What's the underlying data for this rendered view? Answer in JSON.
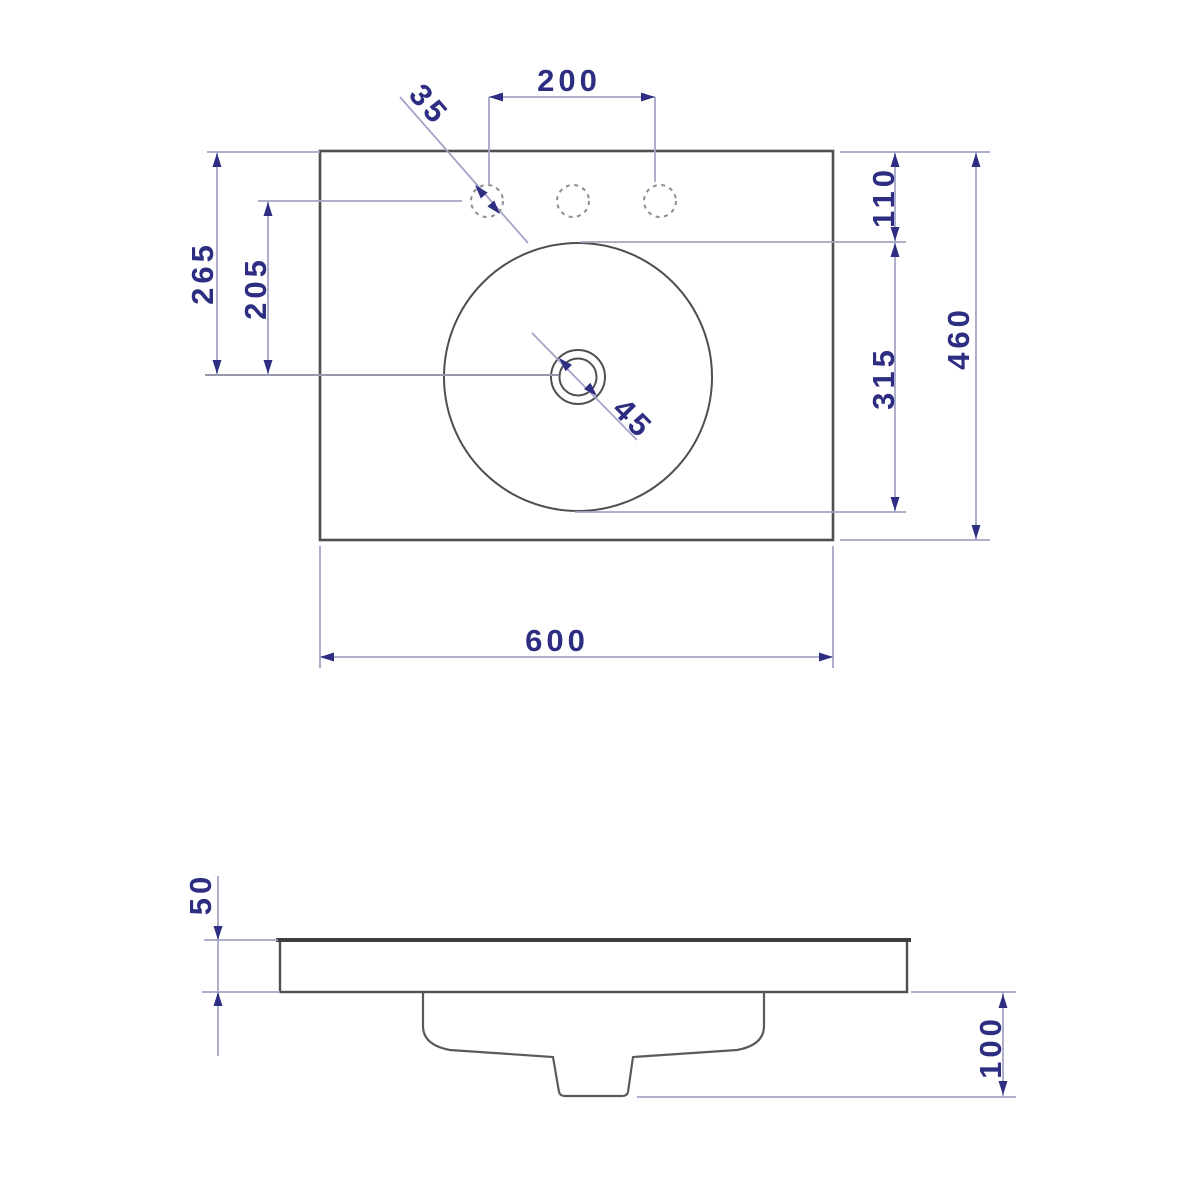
{
  "drawing": {
    "kind": "washbasin-technical-drawing",
    "views": {
      "plan": {
        "labels": {
          "tap_hole_spacing": "200",
          "tap_hole_diameter": "35",
          "edge_to_drain": "265",
          "tap_line_to_drain": "205",
          "edge_to_bowl": "110",
          "bowl_extent": "315",
          "overall_depth": "460",
          "overall_width": "600",
          "waste_diameter": "45"
        }
      },
      "side": {
        "labels": {
          "rim_height": "50",
          "overall_height": "100"
        }
      }
    },
    "colors": {
      "background": "#ffffff",
      "outline": "#4f4f4f",
      "dimension_line": "#a4a4c6",
      "dimension_text": "#2d2d82"
    }
  }
}
